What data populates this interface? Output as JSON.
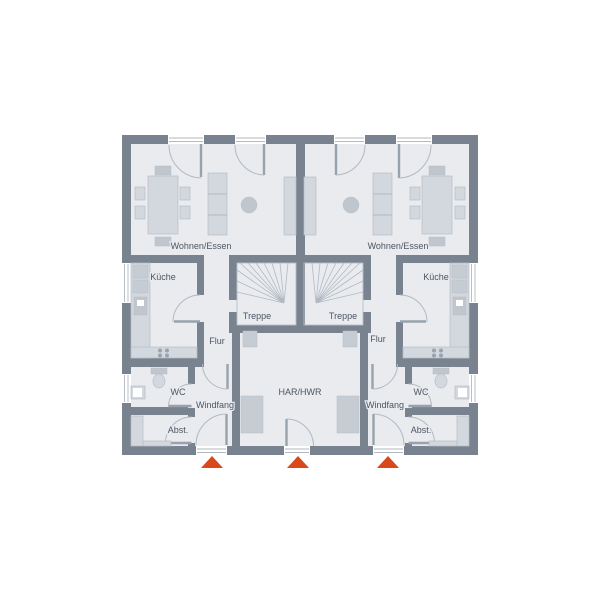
{
  "colors": {
    "wall": "#79828f",
    "floor": "#e9ebef",
    "furniture": "#d3d8de",
    "furniture_stroke": "#b7bec7",
    "furniture_dark": "#bfc6cd",
    "appliance": "#c6ccd3",
    "symbol_line": "#b2b9c2",
    "door_leaf": "#98a2ad",
    "label_text": "#4c5663",
    "entrance_marker": "#d9481c",
    "window": "#ffffff"
  },
  "rooms": [
    {
      "unit": "left",
      "label": "Wohnen/Essen"
    },
    {
      "unit": "left",
      "label": "Küche"
    },
    {
      "unit": "left",
      "label": "Treppe"
    },
    {
      "unit": "left",
      "label": "Flur"
    },
    {
      "unit": "left",
      "label": "WC"
    },
    {
      "unit": "left",
      "label": "Windfang"
    },
    {
      "unit": "left",
      "label": "Abst."
    },
    {
      "unit": "center",
      "label": "HAR/HWR"
    },
    {
      "unit": "right",
      "label": "Wohnen/Essen"
    },
    {
      "unit": "right",
      "label": "Küche"
    },
    {
      "unit": "right",
      "label": "Treppe"
    },
    {
      "unit": "right",
      "label": "Flur"
    },
    {
      "unit": "right",
      "label": "WC"
    },
    {
      "unit": "right",
      "label": "Windfang"
    },
    {
      "unit": "right",
      "label": "Abst."
    }
  ],
  "entrance_markers": {
    "count": 3,
    "positions": [
      "left-unit-entrance",
      "central-har-hwr-entrance",
      "right-unit-entrance"
    ]
  }
}
